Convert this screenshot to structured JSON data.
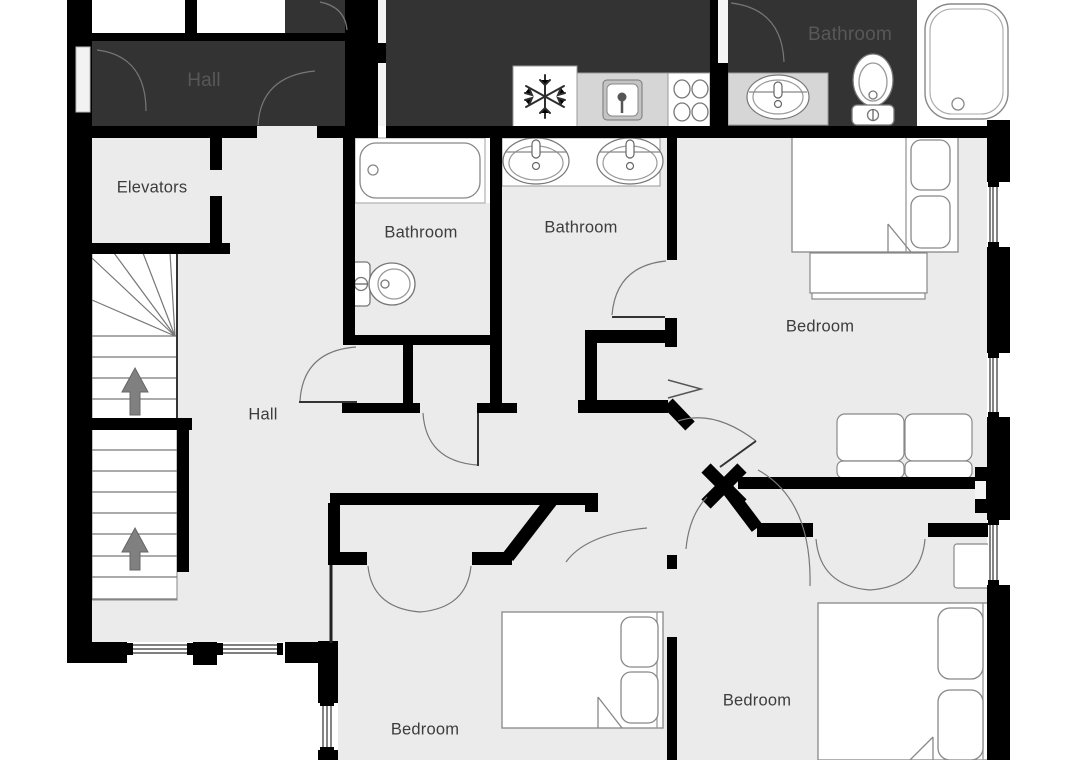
{
  "floorplan": {
    "rooms": [
      {
        "id": "hall-upper",
        "label": "Hall"
      },
      {
        "id": "bathroom-upper-right",
        "label": "Bathroom"
      },
      {
        "id": "elevators",
        "label": "Elevators"
      },
      {
        "id": "bathroom-left",
        "label": "Bathroom"
      },
      {
        "id": "bathroom-middle",
        "label": "Bathroom"
      },
      {
        "id": "hall-main",
        "label": "Hall"
      },
      {
        "id": "bedroom-right",
        "label": "Bedroom"
      },
      {
        "id": "bedroom-bottom-middle",
        "label": "Bedroom"
      },
      {
        "id": "bedroom-bottom-right",
        "label": "Bedroom"
      }
    ],
    "colors": {
      "wall": "#000000",
      "floor": "#ebebeb",
      "dark_room": "#333333",
      "counter": "#d6d6d6",
      "label": "#3c3c3c",
      "dark_room_label": "#585858",
      "stair_arrow": "#808080",
      "furniture_outline": "#888888"
    },
    "icons": {
      "fridge": "snowflake-icon",
      "stove": "four-burners-icon",
      "sinks": "oval-basin-icon",
      "toilets": "toilet-icon",
      "bathtubs": "bathtub-icon",
      "beds": "double-bed-with-pillows-icon",
      "sofa": "two-seat-sofa-icon",
      "stairs": "up-arrow-icon",
      "windows": "triple-line-window-icon",
      "doors": "quarter-arc-door-swing-icon"
    }
  }
}
